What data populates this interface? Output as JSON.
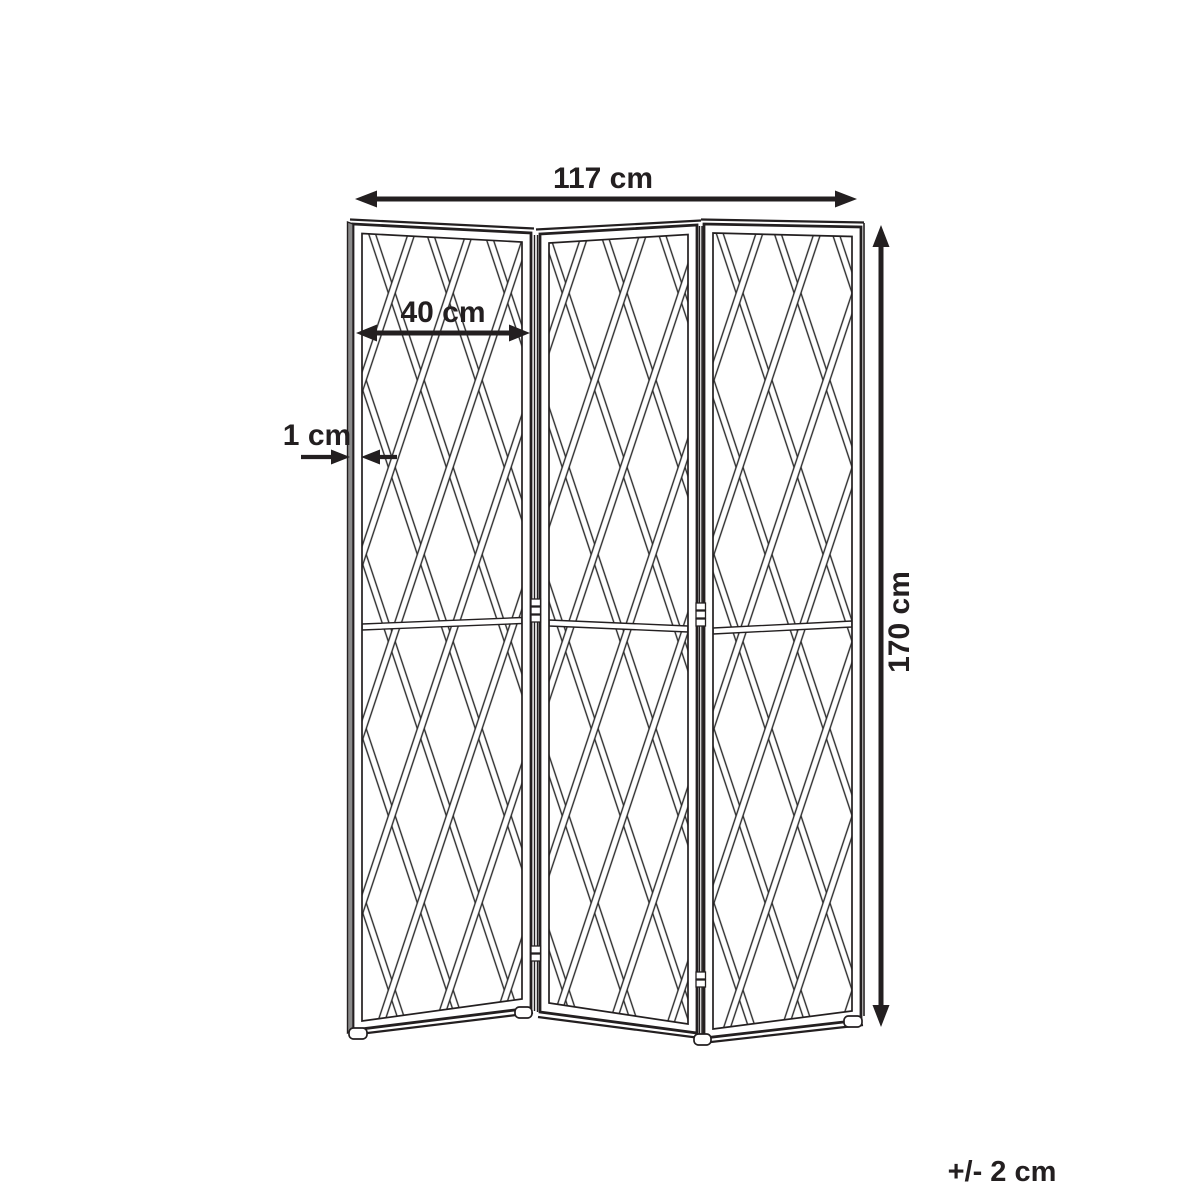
{
  "diagram": {
    "type": "product dimension drawing",
    "subject": "three-panel folding room divider screen with diagonal slat lattice",
    "panel_count": 3,
    "colors": {
      "line": "#231f20",
      "background": "#ffffff",
      "edge_profile": "#8a8a8a"
    },
    "labels": {
      "total_width": "117 cm",
      "panel_width": "40 cm",
      "thickness": "1 cm",
      "height": "170 cm",
      "tolerance": "+/- 2 cm"
    }
  }
}
